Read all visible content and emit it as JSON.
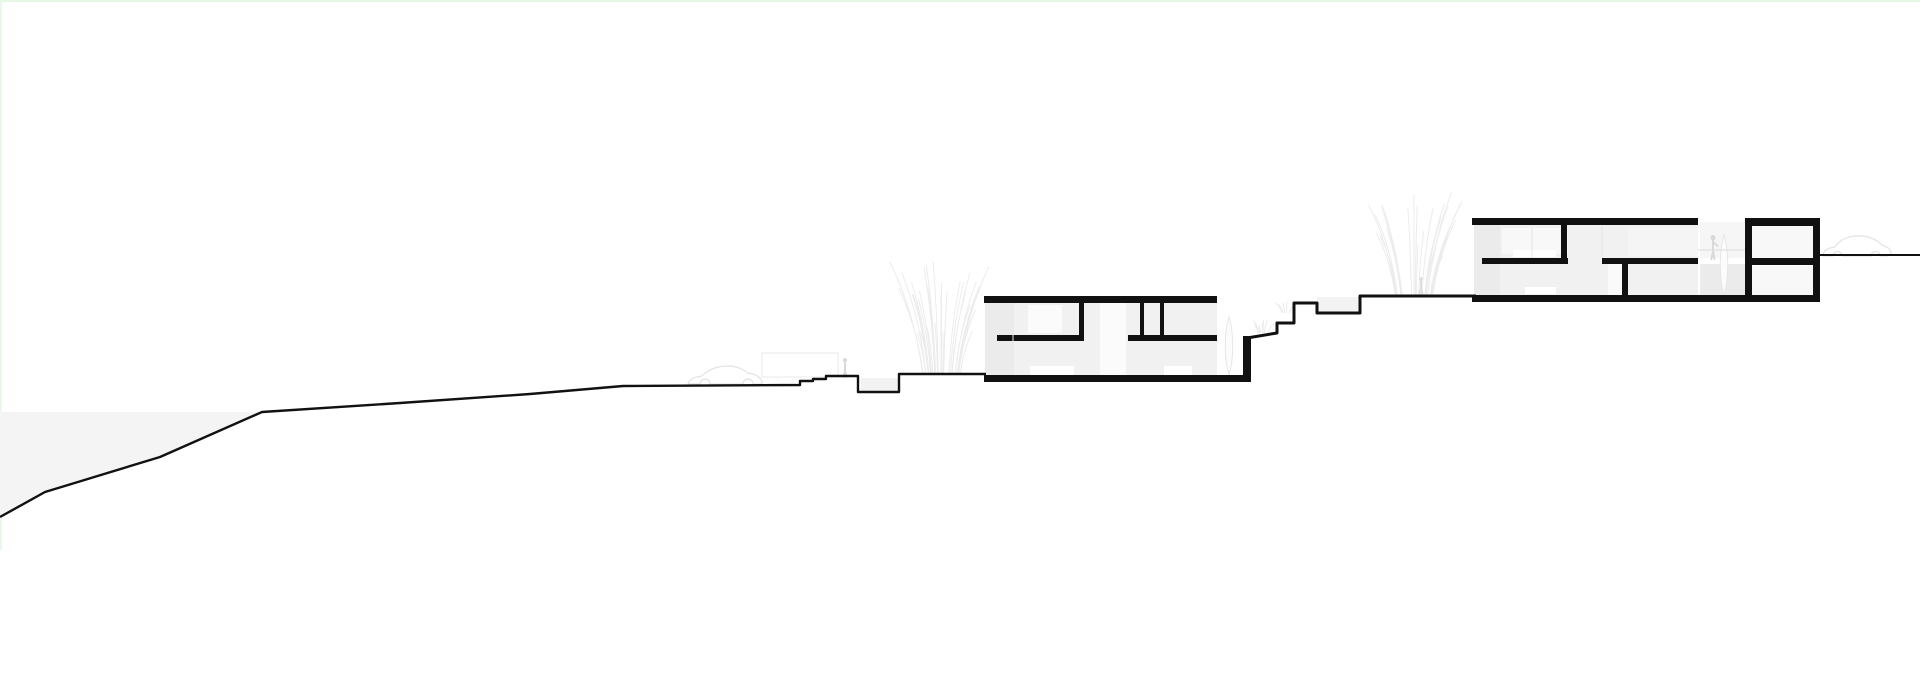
{
  "meta": {
    "width": 1920,
    "height": 678,
    "background": "#ffffff",
    "ink": "#111111"
  },
  "scene": {
    "ink": "#111111",
    "sea": {
      "points": "0,412 262,412 160,457 45,492 0,517",
      "color": "#f4f4f4"
    },
    "edges": [
      {
        "n": "page-edge-top",
        "x": 0,
        "y": 0,
        "w": 1920,
        "h": 2,
        "c": "#e4f8e4"
      },
      {
        "n": "page-edge-left",
        "x": 0,
        "y": 0,
        "w": 2,
        "h": 550,
        "c": "#eaf8ea"
      }
    ],
    "terrain": [
      {
        "n": "terrain-line-main",
        "w": 2.4,
        "d": "M0 517 L45 492 L160 457 L262 412 L400 403 L530 394 L623 386 L800 385 L800 381 L813 381 L813 379 L826 379 L826 376 L858 376 L858 392 L899 392 L899 374 L986 374"
      },
      {
        "n": "terrain-line-mid-steps",
        "w": 3,
        "d": "M1247 338 L1277 333 L1277 323 L1294 323 L1294 303 L1317 303 L1317 313 L1360 313 L1360 296 L1476 296"
      },
      {
        "n": "terrain-line-upper-right",
        "w": 2,
        "d": "M1820 255 L1920 255"
      }
    ],
    "fills": [
      {
        "n": "sunken-court-fill",
        "x": 861,
        "y": 378,
        "w": 38,
        "h": 15,
        "c": "#f2f2f2"
      },
      {
        "n": "planter-step-fill",
        "x": 1317,
        "y": 297,
        "w": 43,
        "h": 16,
        "c": "#f3f3f3"
      },
      {
        "n": "building1-interior-fill",
        "x": 985,
        "y": 303,
        "w": 232,
        "h": 72,
        "c": "#f1f1f1"
      },
      {
        "n": "building1-left-wall-shade",
        "x": 985,
        "y": 303,
        "w": 28,
        "h": 72,
        "c": "#ebebeb"
      },
      {
        "n": "building1-window-upper",
        "x": 1028,
        "y": 305,
        "w": 34,
        "h": 28,
        "c": "#fbfbfb"
      },
      {
        "n": "building1-stair-void",
        "x": 1100,
        "y": 303,
        "w": 26,
        "h": 72,
        "c": "#fbfbfb"
      },
      {
        "n": "building1-furniture-left",
        "x": 1030,
        "y": 366,
        "w": 44,
        "h": 9,
        "c": "#ffffff"
      },
      {
        "n": "building1-furniture-right",
        "x": 1164,
        "y": 366,
        "w": 28,
        "h": 9,
        "c": "#ffffff"
      },
      {
        "n": "building2-interior-fill",
        "x": 1474,
        "y": 225,
        "w": 224,
        "h": 70,
        "c": "#f1f1f1"
      },
      {
        "n": "building2-left-wall-shade",
        "x": 1474,
        "y": 225,
        "w": 26,
        "h": 70,
        "c": "#ebebeb"
      },
      {
        "n": "building2-window-upper",
        "x": 1502,
        "y": 228,
        "w": 66,
        "h": 26,
        "c": "#f8f8f8"
      },
      {
        "n": "building2-shelf-upper",
        "x": 1513,
        "y": 250,
        "w": 43,
        "h": 7,
        "c": "#ffffff"
      },
      {
        "n": "building2-door-void",
        "x": 1608,
        "y": 264,
        "w": 15,
        "h": 31,
        "c": "#fafafa"
      },
      {
        "n": "building2-furniture-lower",
        "x": 1525,
        "y": 287,
        "w": 31,
        "h": 7,
        "c": "#ffffff"
      },
      {
        "n": "building2-room-upper-right",
        "x": 1628,
        "y": 228,
        "w": 70,
        "h": 28,
        "c": "#f5f5f5"
      },
      {
        "n": "terrace-upper-fill",
        "x": 1700,
        "y": 222,
        "w": 46,
        "h": 36,
        "c": "#f6f6f6"
      },
      {
        "n": "terrace-lower-fill",
        "x": 1700,
        "y": 264,
        "w": 46,
        "h": 31,
        "c": "#ebebeb"
      },
      {
        "n": "tower-panel-upper",
        "x": 1752,
        "y": 226,
        "w": 61,
        "h": 33,
        "c": "#f8f8f8"
      },
      {
        "n": "tower-panel-lower",
        "x": 1752,
        "y": 266,
        "w": 61,
        "h": 29,
        "c": "#f8f8f8"
      }
    ],
    "bars": [
      {
        "n": "building1-roof-slab",
        "x": 984,
        "y": 296,
        "w": 233,
        "h": 7
      },
      {
        "n": "building1-floor-slab",
        "x": 984,
        "y": 375,
        "w": 267,
        "h": 7
      },
      {
        "n": "building1-mid-slab-left",
        "x": 997,
        "y": 335,
        "w": 87,
        "h": 6
      },
      {
        "n": "building1-wall-interior-1",
        "x": 1079,
        "y": 302,
        "w": 5,
        "h": 33
      },
      {
        "n": "building1-mid-slab-right",
        "x": 1128,
        "y": 335,
        "w": 89,
        "h": 6
      },
      {
        "n": "building1-wall-interior-2",
        "x": 1140,
        "y": 302,
        "w": 4,
        "h": 33
      },
      {
        "n": "building1-wall-interior-3",
        "x": 1160,
        "y": 302,
        "w": 4,
        "h": 33
      },
      {
        "n": "building1-retaining-wall",
        "x": 1243,
        "y": 336,
        "w": 8,
        "h": 46
      },
      {
        "n": "building2-roof-slab",
        "x": 1472,
        "y": 218,
        "w": 226,
        "h": 7
      },
      {
        "n": "building2-floor-slab",
        "x": 1472,
        "y": 295,
        "w": 348,
        "h": 7
      },
      {
        "n": "building2-mid-slab-left",
        "x": 1482,
        "y": 258,
        "w": 86,
        "h": 6
      },
      {
        "n": "building2-wall-interior-1",
        "x": 1561,
        "y": 225,
        "w": 6,
        "h": 33
      },
      {
        "n": "building2-mid-slab-right",
        "x": 1602,
        "y": 258,
        "w": 96,
        "h": 6
      },
      {
        "n": "building2-wall-interior-2",
        "x": 1622,
        "y": 264,
        "w": 6,
        "h": 31
      },
      {
        "n": "tower-roof-slab",
        "x": 1745,
        "y": 218,
        "w": 75,
        "h": 8
      },
      {
        "n": "tower-wall-left",
        "x": 1745,
        "y": 218,
        "w": 7,
        "h": 84
      },
      {
        "n": "tower-wall-right",
        "x": 1813,
        "y": 218,
        "w": 7,
        "h": 84
      },
      {
        "n": "tower-mid-slab",
        "x": 1745,
        "y": 258,
        "w": 75,
        "h": 7
      }
    ],
    "faint_lines": [
      {
        "n": "terrace-railing-line",
        "x1": 1698,
        "y1": 250,
        "x2": 1745,
        "y2": 250,
        "c": "#dcdcdc",
        "w": 1
      },
      {
        "n": "building1-glass-seam",
        "x1": 1013,
        "y1": 303,
        "x2": 1013,
        "y2": 375,
        "c": "#e7e7e7",
        "w": 1
      },
      {
        "n": "building2-glass-seam-1",
        "x1": 1532,
        "y1": 228,
        "x2": 1532,
        "y2": 258,
        "c": "#e4e4e4",
        "w": 1
      },
      {
        "n": "building2-glass-seam-2",
        "x1": 1602,
        "y1": 226,
        "x2": 1602,
        "y2": 258,
        "c": "#e4e4e4",
        "w": 1
      }
    ],
    "entities": [
      {
        "type": "rect-outline",
        "n": "carport-outline",
        "x": 762,
        "y": 353,
        "w": 76,
        "h": 24,
        "c": "#e9e9e9"
      },
      {
        "type": "car",
        "n": "car-left-outline",
        "x": 687,
        "y": 384,
        "c": "#e3e3e3",
        "d": "M1 0 C2 -5 8 -7 15 -8 C21 -14 30 -18 41 -18 C51 -18 57 -14 61 -11 C68 -10 73 -7 75 -3 C76 -1 75 0 73 0 L66 0 A5 5 0 0 0 56 0 L23 0 A5 5 0 0 0 13 0 Z"
      },
      {
        "type": "car",
        "n": "car-right-outline",
        "x": 1822,
        "y": 256,
        "c": "#e3e3e3",
        "d": "M1 0 C1 -5 5 -8 13 -9 C18 -17 28 -21 40 -20 C50 -19 56 -15 60 -11 C66 -9 69 -6 69 -3 C69 -1 67 0 65 0 L58 0 A4.5 4.5 0 0 0 49 0 L20 0 A4.5 4.5 0 0 0 11 0 Z"
      },
      {
        "type": "grass",
        "n": "grass-cluster-left",
        "x": 941,
        "y": 374,
        "h": 115,
        "spread": 60,
        "count": 34,
        "seed": 3,
        "c": "#ececec"
      },
      {
        "type": "grass",
        "n": "grass-cluster-middle",
        "x": 1414,
        "y": 295,
        "h": 110,
        "spread": 56,
        "count": 30,
        "seed": 7,
        "c": "#ececec"
      },
      {
        "type": "grass",
        "n": "grass-tuft-slope-1",
        "x": 1263,
        "y": 333,
        "h": 14,
        "spread": 14,
        "count": 10,
        "seed": 11,
        "c": "#ececec"
      },
      {
        "type": "grass",
        "n": "grass-tuft-slope-2",
        "x": 1286,
        "y": 313,
        "h": 12,
        "spread": 12,
        "count": 8,
        "seed": 5,
        "c": "#ececec"
      },
      {
        "type": "cypress",
        "n": "cypress-plant-1",
        "x": 1229,
        "y": 375,
        "h": 58,
        "hw": 5,
        "c": "#e6e6e6"
      },
      {
        "type": "cypress",
        "n": "cypress-plant-2",
        "x": 1724,
        "y": 295,
        "h": 60,
        "hw": 5,
        "c": "#e6e6e6"
      },
      {
        "type": "person",
        "n": "person-figure-path",
        "x": 845,
        "y": 377,
        "h": 19,
        "arm": false,
        "c": "#d9d9d9"
      },
      {
        "type": "person",
        "n": "person-figure-grass",
        "x": 1421,
        "y": 294,
        "h": 17,
        "arm": false,
        "c": "#dedede"
      },
      {
        "type": "person",
        "n": "person-figure-terrace",
        "x": 1713,
        "y": 259,
        "h": 24,
        "arm": true,
        "c": "#d9d9d9"
      }
    ]
  }
}
